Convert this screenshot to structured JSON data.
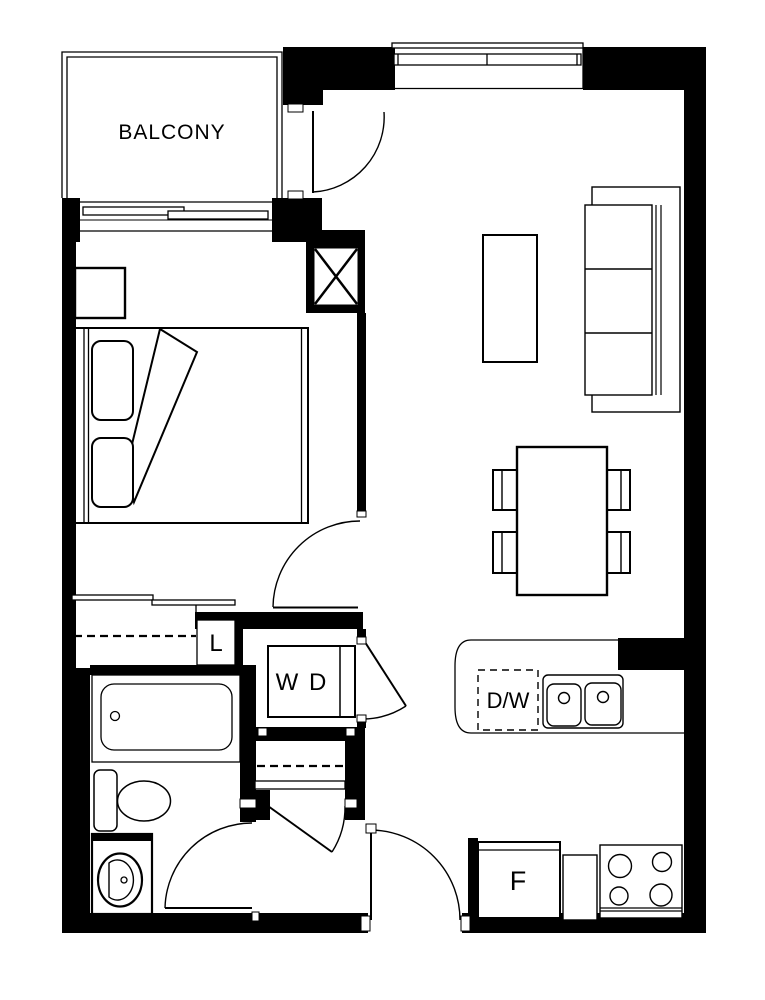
{
  "title": "apartment-floor-plan",
  "labels": {
    "balcony": "BALCONY",
    "linen_closet": "L",
    "washer_dryer": "W D",
    "dishwasher": "D/W",
    "fridge": "F"
  },
  "colors": {
    "line": "#000000",
    "background": "#ffffff"
  }
}
